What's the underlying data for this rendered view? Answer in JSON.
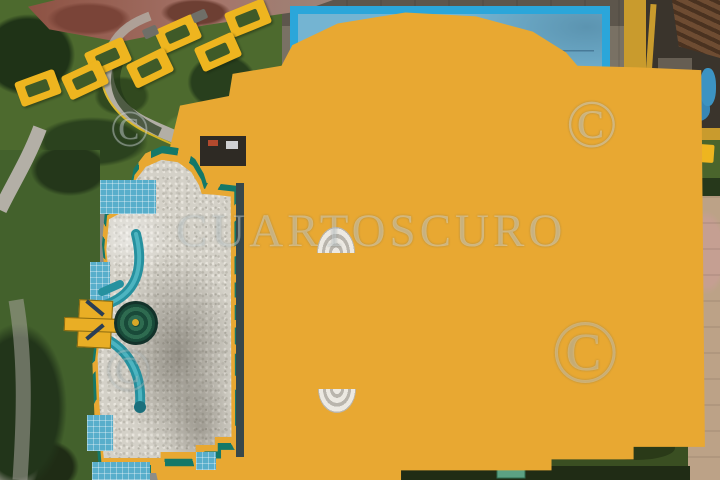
{
  "watermark": {
    "agency": "CUARTOSCURO",
    "symbol": "©"
  },
  "scene": {
    "type": "aerial-drone-photo",
    "subject": "Top-down view of a public swimming pool complex: an empty light-blue lap pool at top, a larger turquoise lap pool with six lane ropes and white paint cracks below, a drained free-form kidney pool with ornate orange-and-teal tiled border, gravel bed and two teal water slides with a yellow tower and green spiral slide on the left, yellow picnic benches on a lawn at top left, a service yard with corrugated roof at top right, gray decks with yellow safety lines and grass strips"
  },
  "colors": {
    "deck-gray": "#8d8d87",
    "deck-dark": "#57544a",
    "lawn-green": "#4d6a2e",
    "hedge-dark": "#26381b",
    "dirt-red": "#96604c",
    "path-gray": "#b3afa6",
    "pool-coping-blue": "#2ba6da",
    "upper-pool-blue": "#74b4d2",
    "lane-navy": "#1d3a57",
    "lower-pool-teal": "#5db2bf",
    "shallow-teal": "#579fa2",
    "crack-white": "#dff2ef",
    "border-orange": "#e8a832",
    "border-teal": "#157868",
    "gravel-light": "#d4d1c8",
    "slide-teal": "#26919f",
    "tower-yellow": "#e9ae25",
    "bench-yellow": "#eeb51f",
    "yellow-line": "#e3bc25",
    "blue-deck": "#4190b2",
    "navy-coping": "#1d2c48",
    "red-line": "#b97f7f",
    "pavement-tan": "#bca287",
    "roof-brown": "#6e4c32",
    "wall-yellow": "#c99b2d",
    "stairs-white": "#ece9e2"
  }
}
